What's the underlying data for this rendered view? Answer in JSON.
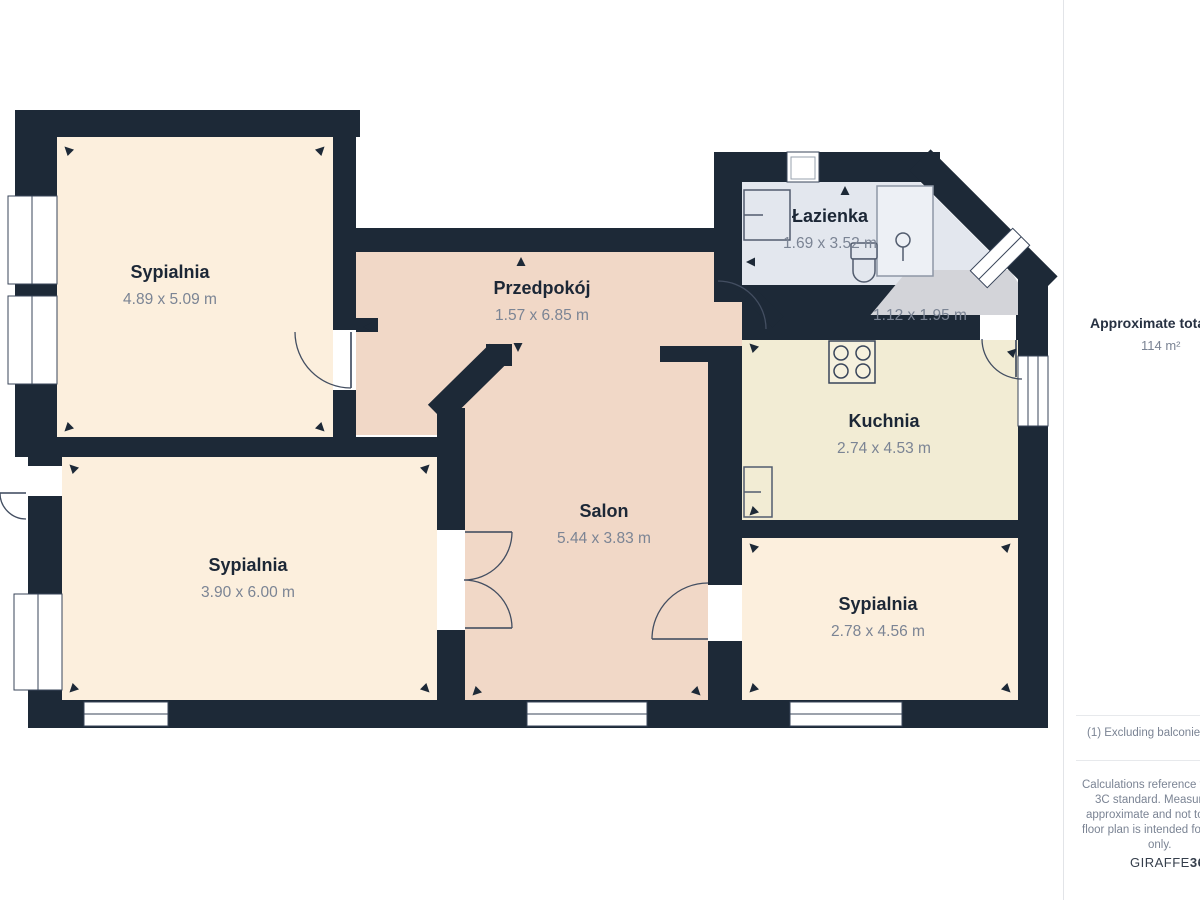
{
  "plan": {
    "rooms": [
      {
        "id": "bedroom-1",
        "name": "Sypialnia",
        "dims": "4.89 x 5.09 m"
      },
      {
        "id": "hallway",
        "name": "Przedpokój",
        "dims": "1.57 x 6.85 m"
      },
      {
        "id": "bathroom",
        "name": "Łazienka",
        "dims": "1.69 x 3.52 m"
      },
      {
        "id": "wc",
        "name": "",
        "dims": "1.12 x 1.95 m"
      },
      {
        "id": "kitchen",
        "name": "Kuchnia",
        "dims": "2.74 x 4.53 m"
      },
      {
        "id": "salon",
        "name": "Salon",
        "dims": "5.44 x 3.83 m"
      },
      {
        "id": "bedroom-2",
        "name": "Sypialnia",
        "dims": "3.90 x 6.00 m"
      },
      {
        "id": "bedroom-3",
        "name": "Sypialnia",
        "dims": "2.78 x 4.56 m"
      }
    ],
    "fixtures": [
      "washing-machine-icon",
      "shower-icon",
      "toilet-icon",
      "stove-icon",
      "kitchen-sink-icon"
    ],
    "colors": {
      "wall": "#1d2937",
      "bedroom_floor": "#fcefdd",
      "hallway_salon_floor": "#f1d8c7",
      "bathroom_floor": "#e3e7ee",
      "kitchen_floor": "#f2ecd4",
      "wc_floor": "#d3d4d9",
      "shower": "#edf0f5",
      "room_name_text": "#1c2736",
      "dims_text": "#7b8494"
    }
  },
  "sidebar": {
    "total_label": "Approximate total area",
    "total_value": "114 m²",
    "footnote": "(1) Excluding balconies and",
    "disclaimer_lines": [
      "Calculations reference the RIC",
      "3C standard. Measurement",
      "approximate and not to scal",
      "floor plan is intended for illus",
      "only."
    ],
    "brand": {
      "name": "GIRAFFE",
      "suffix": "360"
    }
  }
}
